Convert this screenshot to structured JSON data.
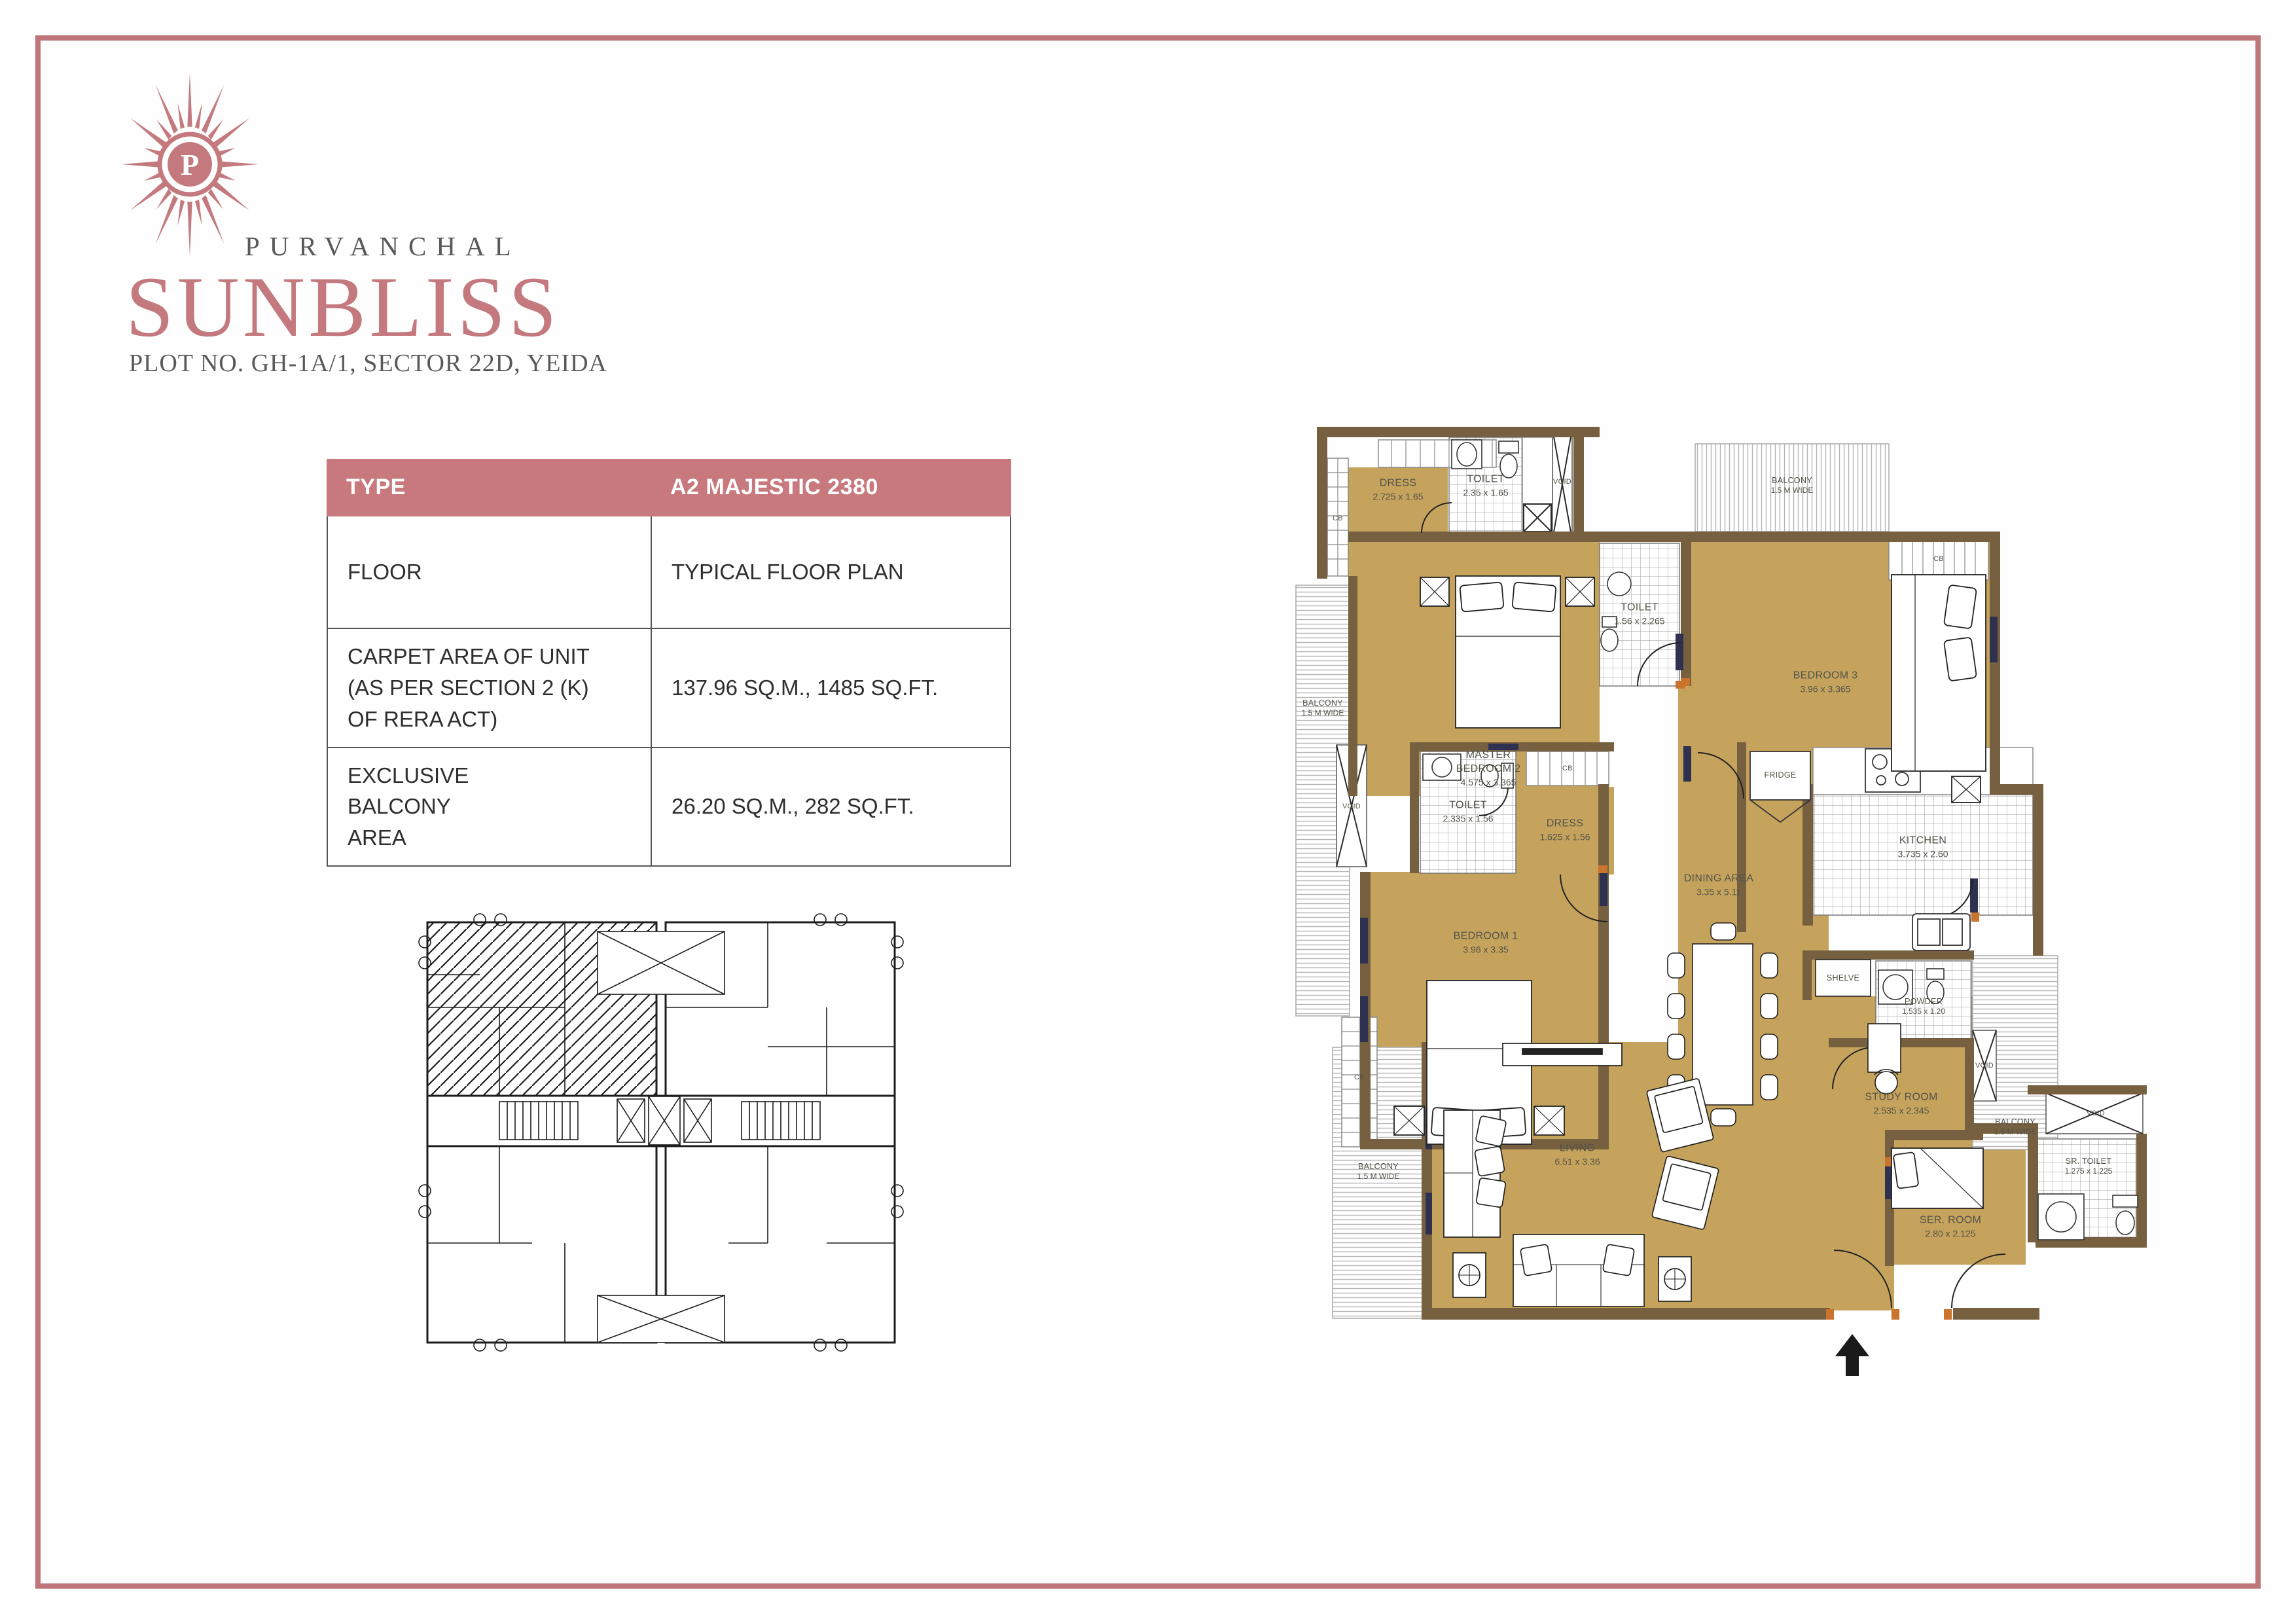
{
  "brand": {
    "name": "PURVANCHAL",
    "project": "SUNBLISS",
    "plot_line": "PLOT NO. GH-1A/1, SECTOR 22D, YEIDA",
    "logo_letter": "P",
    "accent_color": "#C4797E",
    "text_color": "#58595B"
  },
  "spec_table": {
    "header": {
      "label": "TYPE",
      "value": "A2 MAJESTIC 2380"
    },
    "rows": [
      {
        "label": "FLOOR",
        "value": "TYPICAL FLOOR PLAN"
      },
      {
        "label": "CARPET AREA OF UNIT\n(AS PER SECTION 2 (K)\nOF RERA ACT)",
        "value": "137.96 SQ.M., 1485 SQ.FT."
      },
      {
        "label": "EXCLUSIVE\nBALCONY\nAREA",
        "value": "26.20 SQ.M., 282 SQ.FT."
      }
    ],
    "header_bg": "#C8797E",
    "border_color": "#54565A"
  },
  "floor_plan": {
    "wall_color": "#76603F",
    "floor_color": "#C6A35C",
    "door_jamb_color": "#C9732C",
    "window_color": "#2E3150",
    "labels": [
      {
        "name": "DRESS",
        "dims": "2.725 x 1.65"
      },
      {
        "name": "TOILET",
        "dims": "2.35 x 1.65"
      },
      {
        "name": "VOID",
        "dims": ""
      },
      {
        "name": "BALCONY",
        "dims": "1.5 M WIDE"
      },
      {
        "name": "CB",
        "dims": ""
      },
      {
        "name": "CB",
        "dims": ""
      },
      {
        "name": "BEDROOM 3",
        "dims": "3.96 x 3.365"
      },
      {
        "name": "MASTER BEDROOM 2",
        "dims": "4.575 x 3.365"
      },
      {
        "name": "TOILET",
        "dims": "1.56 x 2.265"
      },
      {
        "name": "BALCONY",
        "dims": "1.5 M WIDE"
      },
      {
        "name": "VOID",
        "dims": ""
      },
      {
        "name": "TOILET",
        "dims": "2.335 x 1.56"
      },
      {
        "name": "DRESS",
        "dims": "1.625 x 1.56"
      },
      {
        "name": "CB",
        "dims": ""
      },
      {
        "name": "BEDROOM 1",
        "dims": "3.96 x 3.35"
      },
      {
        "name": "CB",
        "dims": ""
      },
      {
        "name": "DINING AREA",
        "dims": "3.35 x 5.11"
      },
      {
        "name": "FRIDGE",
        "dims": ""
      },
      {
        "name": "KITCHEN",
        "dims": "3.735 x 2.60"
      },
      {
        "name": "SHELVE",
        "dims": ""
      },
      {
        "name": "POWDER",
        "dims": "1.535 x 1.20"
      },
      {
        "name": "VOID",
        "dims": ""
      },
      {
        "name": "BALCONY",
        "dims": "1.5 M WIDE"
      },
      {
        "name": "BALCONY",
        "dims": "1.5 M WIDE"
      },
      {
        "name": "LIVING",
        "dims": "6.51 x 3.36"
      },
      {
        "name": "STUDY ROOM",
        "dims": "2.535 x 2.345"
      },
      {
        "name": "SER. ROOM",
        "dims": "2.80 x 2.125"
      },
      {
        "name": "SR. TOILET",
        "dims": "1.275 x 1.225"
      },
      {
        "name": "VOID",
        "dims": ""
      }
    ]
  }
}
